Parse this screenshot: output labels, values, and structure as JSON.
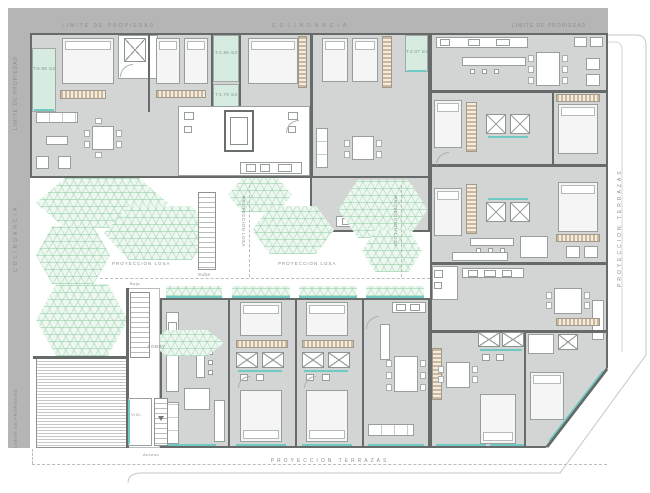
{
  "labels": {
    "limite_de_propiedad": "LIMITE DE PROPIEDAD",
    "colindancia": "COLINDANCIA",
    "proyeccion_terrazas": "PROYECCION TERRAZAS",
    "proyeccion_losa": "PROYECCION LOSA",
    "lobby": "LOBBY",
    "vigilancia": "VIGI.",
    "acceso": "Acceso",
    "sube": "Sube",
    "baja": "Baja"
  },
  "terraces": [
    {
      "label": "T:6.89 m2"
    },
    {
      "label": "T:4.89 m2"
    },
    {
      "label": "T:4.79 m2"
    },
    {
      "label": "T:4.07 m2"
    }
  ],
  "colors": {
    "band": "#b5b5b5",
    "wall": "#666b69",
    "floor": "#d3d5d4",
    "terrace": "#d7ece0",
    "window": "#6fcac4",
    "closet": "#cdb79c",
    "outline": "#c6c6c6",
    "label": "#8d8d8d"
  }
}
